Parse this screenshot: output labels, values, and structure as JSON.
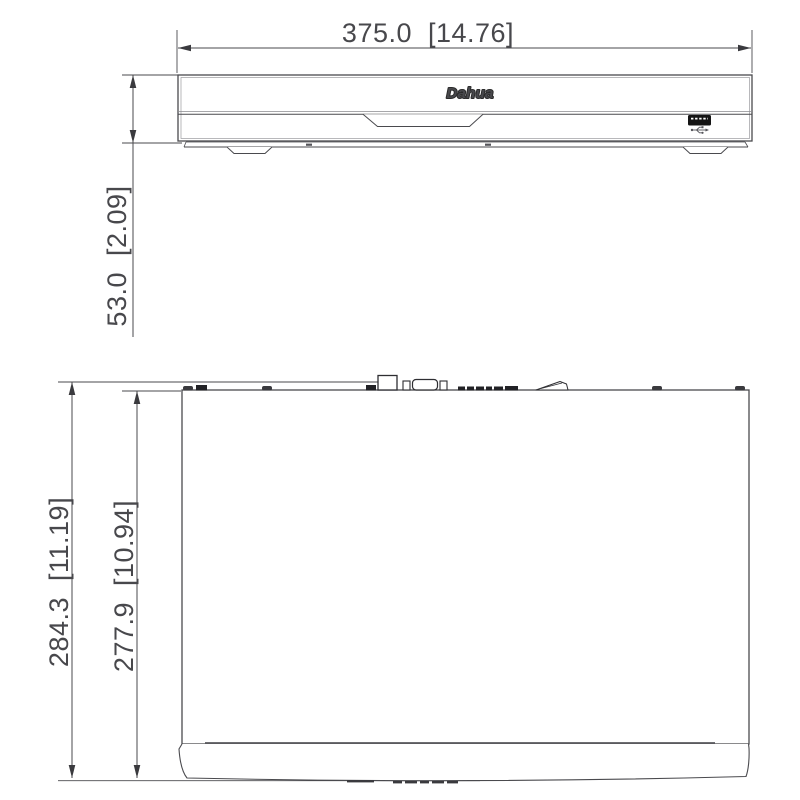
{
  "drawing": {
    "kind": "technical-dimension-drawing",
    "product": "network video recorder chassis",
    "line_color": "#4a4a4e",
    "background": "#ffffff",
    "views": {
      "front": {
        "name": "Front view",
        "logo_text": "Dahua"
      },
      "top": {
        "name": "Top view"
      }
    },
    "dimensions": {
      "width": {
        "label": "375.0  [14.76]",
        "mm": 375.0,
        "inches": 14.76
      },
      "height": {
        "label": "53.0  [2.09]",
        "mm": 53.0,
        "inches": 2.09
      },
      "depth_overall": {
        "label": "284.3  [11.19]",
        "mm": 284.3,
        "inches": 11.19
      },
      "depth_chassis": {
        "label": "277.9  [10.94]",
        "mm": 277.9,
        "inches": 10.94
      }
    }
  }
}
